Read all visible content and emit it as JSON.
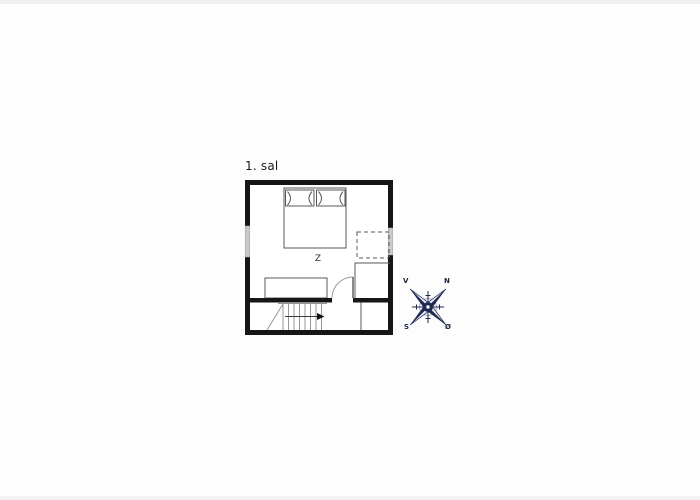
{
  "canvas": {
    "background": "#fdfdfd",
    "edge_strip_color": "#efefef"
  },
  "floor_plan": {
    "title": "1. sal",
    "room_label": "Z",
    "colors": {
      "wall": "#161616",
      "thin_line": "#585858",
      "stair_line": "#979797",
      "window": "#c9c9c9"
    }
  },
  "compass": {
    "labels": {
      "west": "V",
      "north": "N",
      "south": "S",
      "east": "Ø"
    },
    "colors": {
      "navy": "#1e2a52",
      "light": "#e8ecf4",
      "ring": "#a9b2c4"
    }
  }
}
